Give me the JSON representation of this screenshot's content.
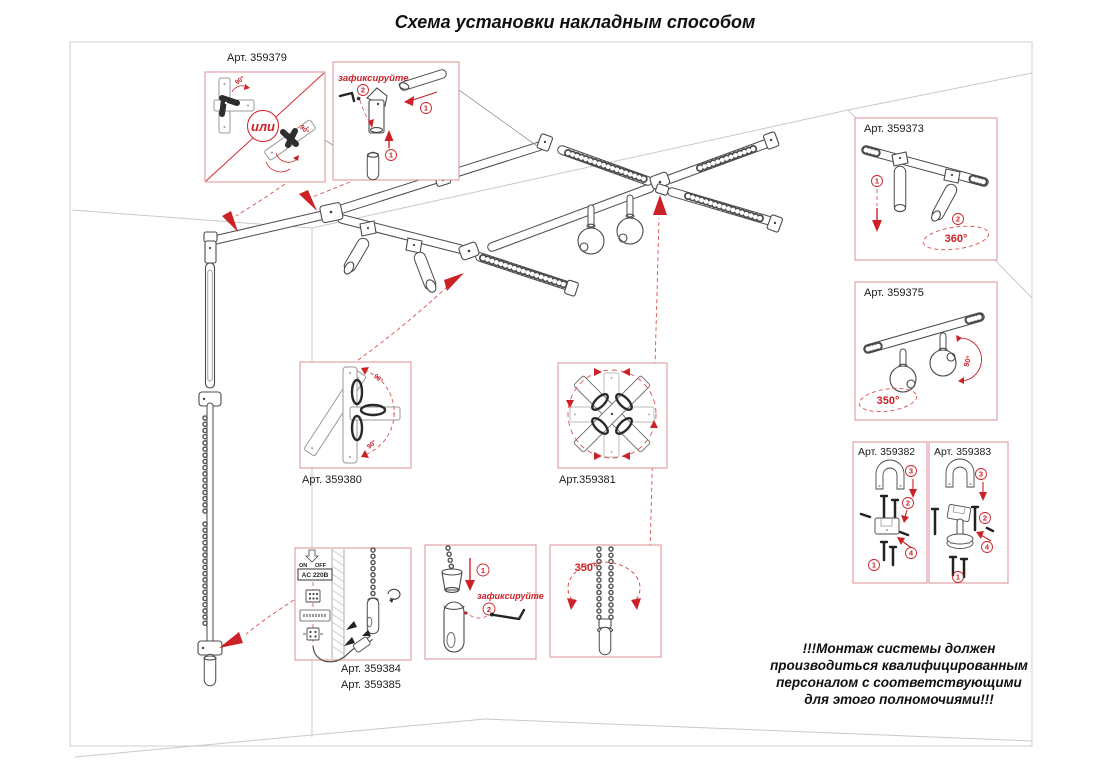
{
  "title": "Схема установки накладным способом",
  "warning": {
    "line1": "!!!Монтаж системы должен",
    "line2": "производиться квалифицированным",
    "line3": "персоналом с соответствующими",
    "line4": "для этого полномочиями!!!"
  },
  "colors": {
    "accent_red": "#cc2127",
    "callout_border": "#dd9093",
    "line_art": "#4a4a4a",
    "room_lines": "#c9c9c9"
  },
  "callouts": {
    "corner_connector": {
      "label": "Арт. 359379",
      "or_text": "или",
      "angle_top": "90°",
      "angle_bottom": "90°"
    },
    "fixation_top": {
      "caption": "зафиксируйте",
      "step1": "1",
      "step2": "2"
    },
    "spots_duo": {
      "label": "Арт. 359373",
      "step1": "1",
      "step2": "2",
      "rotation": "360°"
    },
    "balls_duo": {
      "label": "Арт. 359375",
      "rotation": "350°",
      "tilt": "90°"
    },
    "bracket_382": {
      "label": "Арт. 359382",
      "step1": "1",
      "step2": "2",
      "step3": "3",
      "step4": "4"
    },
    "bracket_383": {
      "label": "Арт. 359383",
      "step1": "1",
      "step2": "2",
      "step3": "3",
      "step4": "4"
    },
    "cross_plate": {
      "label": "Арт. 359380",
      "angle_top": "90°",
      "angle_bottom": "90°"
    },
    "star_plate": {
      "label": "Арт.359381"
    },
    "power_unit": {
      "label_1": "Арт. 359384",
      "label_2": "Арт. 359385",
      "on": "ON",
      "off": "OFF",
      "voltage": "AC 220В"
    },
    "fixation_bottom": {
      "caption": "зафиксируйте",
      "step1": "1",
      "step2": "2"
    },
    "chain_rotation": {
      "rotation": "350°"
    }
  }
}
